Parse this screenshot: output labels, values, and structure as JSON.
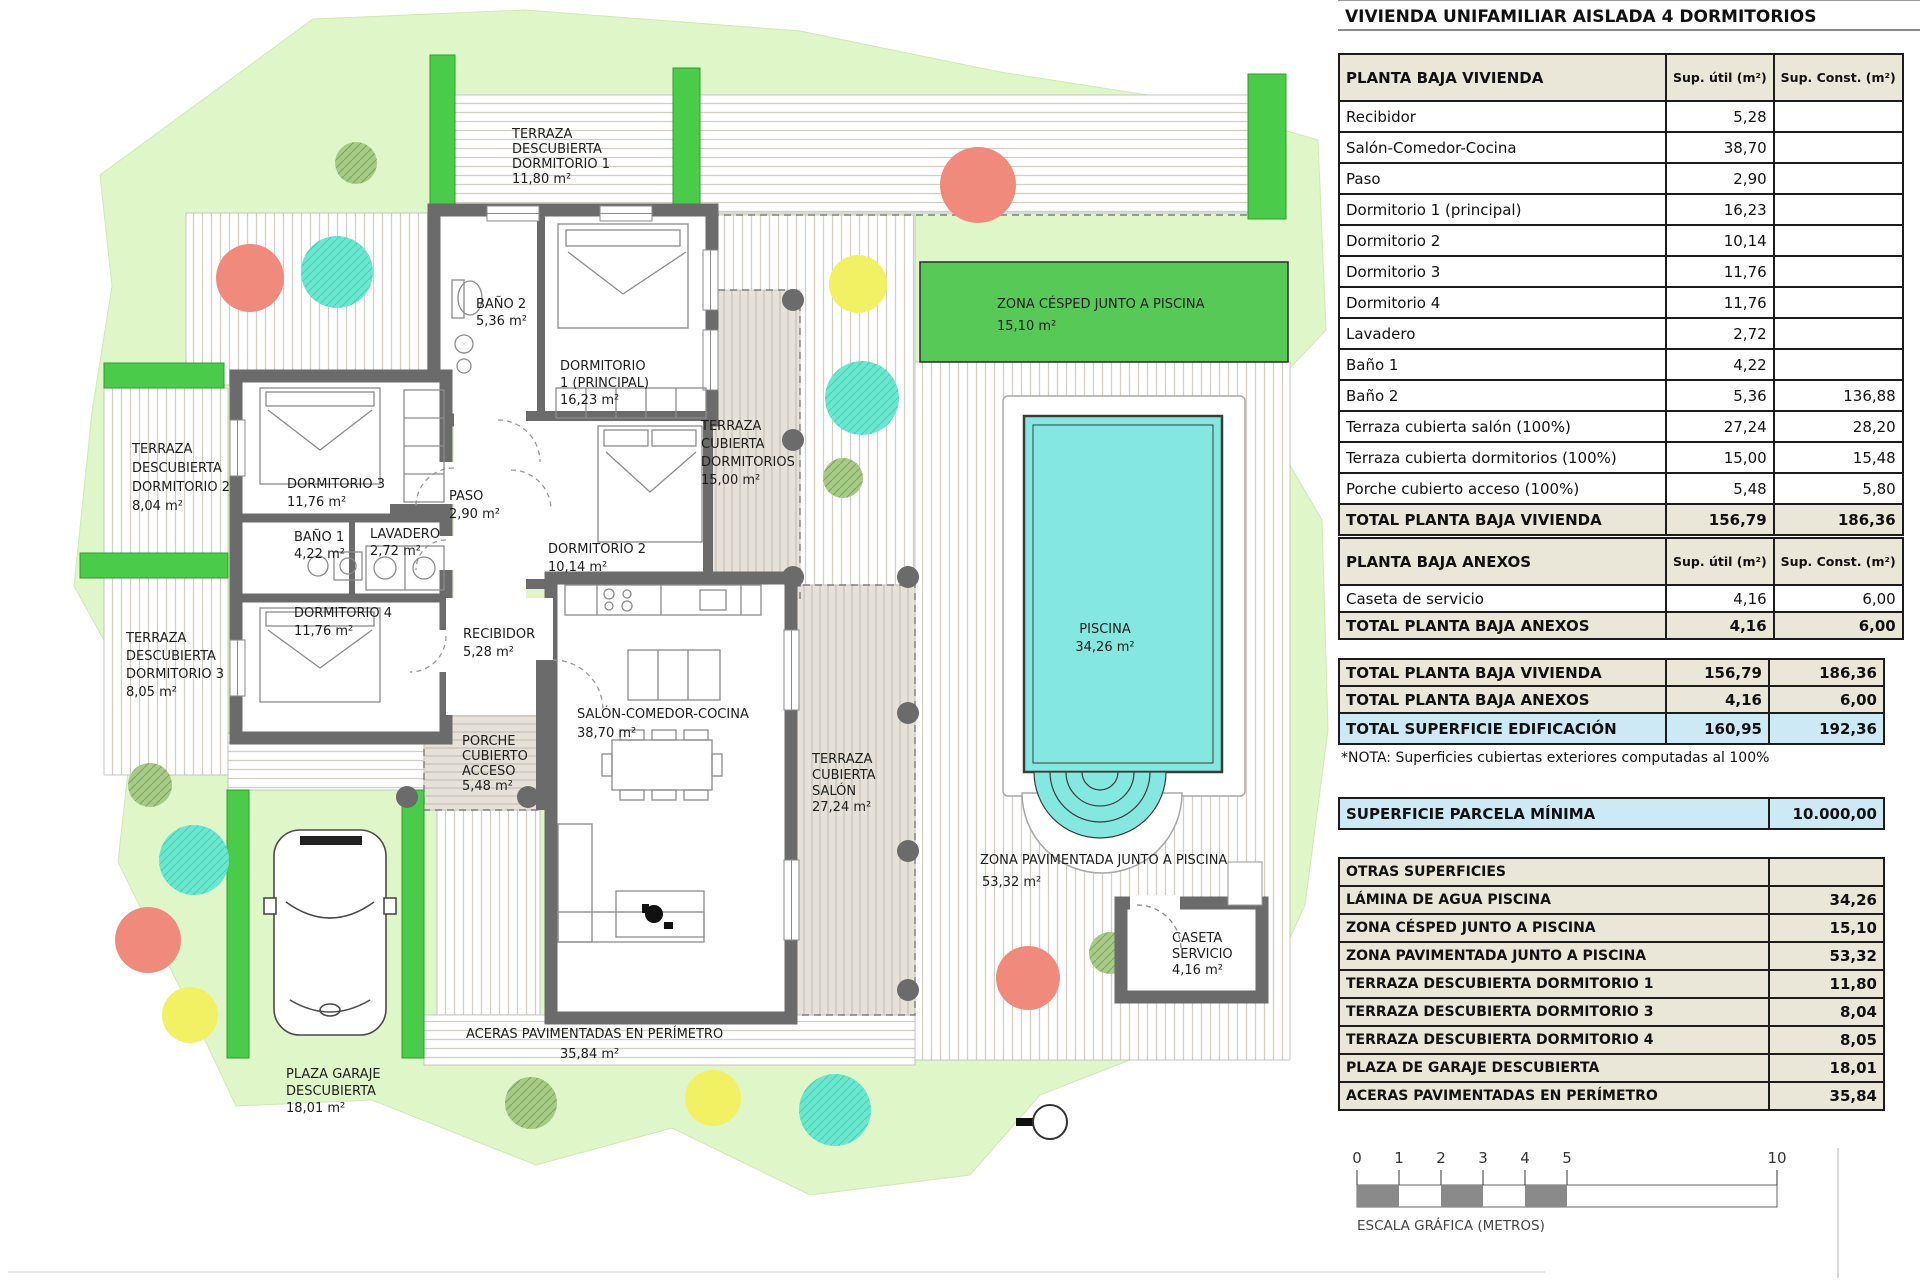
{
  "title": "VIVIENDA UNIFAMILIAR AISLADA 4 DORMITORIOS",
  "tables": {
    "main": {
      "header": {
        "label": "PLANTA BAJA VIVIENDA",
        "util": "Sup. útil (m²)",
        "const": "Sup. Const. (m²)"
      },
      "rows": [
        {
          "label": "Recibidor",
          "util": "5,28",
          "const": ""
        },
        {
          "label": "Salón-Comedor-Cocina",
          "util": "38,70",
          "const": ""
        },
        {
          "label": "Paso",
          "util": "2,90",
          "const": ""
        },
        {
          "label": "Dormitorio 1 (principal)",
          "util": "16,23",
          "const": ""
        },
        {
          "label": "Dormitorio 2",
          "util": "10,14",
          "const": ""
        },
        {
          "label": "Dormitorio 3",
          "util": "11,76",
          "const": ""
        },
        {
          "label": "Dormitorio 4",
          "util": "11,76",
          "const": ""
        },
        {
          "label": "Lavadero",
          "util": "2,72",
          "const": ""
        },
        {
          "label": "Baño 1",
          "util": "4,22",
          "const": ""
        },
        {
          "label": "Baño 2",
          "util": "5,36",
          "const": "136,88"
        },
        {
          "label": "Terraza cubierta salón (100%)",
          "util": "27,24",
          "const": "28,20"
        },
        {
          "label": "Terraza cubierta dormitorios (100%)",
          "util": "15,00",
          "const": "15,48"
        },
        {
          "label": "Porche cubierto acceso (100%)",
          "util": "5,48",
          "const": "5,80"
        }
      ],
      "total": {
        "label": "TOTAL PLANTA BAJA VIVIENDA",
        "util": "156,79",
        "const": "186,36"
      }
    },
    "anexos": {
      "header": {
        "label": "PLANTA BAJA ANEXOS",
        "util": "Sup. útil (m²)",
        "const": "Sup. Const. (m²)"
      },
      "rows": [
        {
          "label": "Caseta de servicio",
          "util": "4,16",
          "const": "6,00"
        }
      ],
      "total": {
        "label": "TOTAL PLANTA BAJA ANEXOS",
        "util": "4,16",
        "const": "6,00"
      }
    },
    "summary": {
      "rows": [
        {
          "label": "TOTAL PLANTA BAJA VIVIENDA",
          "util": "156,79",
          "const": "186,36"
        },
        {
          "label": "TOTAL PLANTA BAJA ANEXOS",
          "util": "4,16",
          "const": "6,00"
        },
        {
          "label": "TOTAL SUPERFICIE EDIFICACIÓN",
          "util": "160,95",
          "const": "192,36"
        }
      ]
    },
    "nota": "*NOTA: Superficies cubiertas exteriores computadas al 100%",
    "parcela": {
      "label": "SUPERFICIE PARCELA MÍNIMA",
      "value": "10.000,00"
    },
    "otras": {
      "header": "OTRAS SUPERFICIES",
      "rows": [
        {
          "label": "LÁMINA DE AGUA PISCINA",
          "value": "34,26"
        },
        {
          "label": "ZONA CÉSPED JUNTO A PISCINA",
          "value": "15,10"
        },
        {
          "label": "ZONA PAVIMENTADA JUNTO A PISCINA",
          "value": "53,32"
        },
        {
          "label": "TERRAZA DESCUBIERTA DORMITORIO 1",
          "value": "11,80"
        },
        {
          "label": "TERRAZA DESCUBIERTA DORMITORIO 3",
          "value": "8,04"
        },
        {
          "label": "TERRAZA DESCUBIERTA DORMITORIO 4",
          "value": "8,05"
        },
        {
          "label": "PLAZA DE GARAJE DESCUBIERTA",
          "value": "18,01"
        },
        {
          "label": "ACERAS PAVIMENTADAS EN PERÍMETRO",
          "value": "35,84"
        }
      ]
    }
  },
  "scale": {
    "ticks": [
      "0",
      "1",
      "2",
      "3",
      "4",
      "5",
      "10"
    ],
    "caption": "ESCALA GRÁFICA (METROS)"
  },
  "plan": {
    "labels": {
      "td1": [
        "TERRAZA",
        "DESCUBIERTA",
        "DORMITORIO 1",
        "11,80 m²"
      ],
      "banio2": [
        "BAÑO 2",
        "5,36 m²"
      ],
      "dorm1": [
        "DORMITORIO",
        "1 (PRINCIPAL)",
        "16,23 m²"
      ],
      "tcd": [
        "TERRAZA",
        "CUBIERTA",
        "DORMITORIOS",
        "15,00 m²"
      ],
      "cesped": [
        "ZONA CÉSPED JUNTO A PISCINA",
        "15,10 m²"
      ],
      "td2": [
        "TERRAZA",
        "DESCUBIERTA",
        "DORMITORIO 2",
        "8,04 m²"
      ],
      "dorm3": [
        "DORMITORIO 3",
        "11,76 m²"
      ],
      "paso": [
        "PASO",
        "2,90 m²"
      ],
      "banio1": [
        "BAÑO 1",
        "4,22 m²"
      ],
      "lavadero": [
        "LAVADERO",
        "2,72 m²"
      ],
      "dorm2": [
        "DORMITORIO 2",
        "10,14 m²"
      ],
      "td3": [
        "TERRAZA",
        "DESCUBIERTA",
        "DORMITORIO 3",
        "8,05 m²"
      ],
      "dorm4": [
        "DORMITORIO 4",
        "11,76 m²"
      ],
      "recibidor": [
        "RECIBIDOR",
        "5,28 m²"
      ],
      "salon": [
        "SALÓN-COMEDOR-COCINA",
        "38,70 m²"
      ],
      "porche": [
        "PORCHE",
        "CUBIERTO",
        "ACCESO",
        "5,48 m²"
      ],
      "tcs": [
        "TERRAZA",
        "CUBIERTA",
        "SALÓN",
        "27,24 m²"
      ],
      "piscina": [
        "PISCINA",
        "34,26 m²"
      ],
      "zonapav": [
        "ZONA PAVIMENTADA JUNTO A PISCINA",
        "53,32 m²"
      ],
      "caseta": [
        "CASETA",
        "SERVICIO",
        "4,16 m²"
      ],
      "aceras": [
        "ACERAS PAVIMENTADAS EN PERÍMETRO",
        "35,84 m²"
      ],
      "plaza": [
        "PLAZA GARAJE",
        "DESCUBIERTA",
        "18,01 m²"
      ]
    }
  },
  "colors": {
    "parcel_green": "#dff6c9",
    "hedge_green": "#4acb4a",
    "cesped_green": "#57c957",
    "pool_cyan": "#85e8e0",
    "wall_gray": "#6b6b6b",
    "table_beige": "#eae6d8",
    "table_blue": "#cde9f5",
    "tree_salmon": "#f08a7c",
    "tree_teal": "#69e8cf",
    "tree_yellow": "#f2f164",
    "tree_olive": "#a7ca86"
  }
}
